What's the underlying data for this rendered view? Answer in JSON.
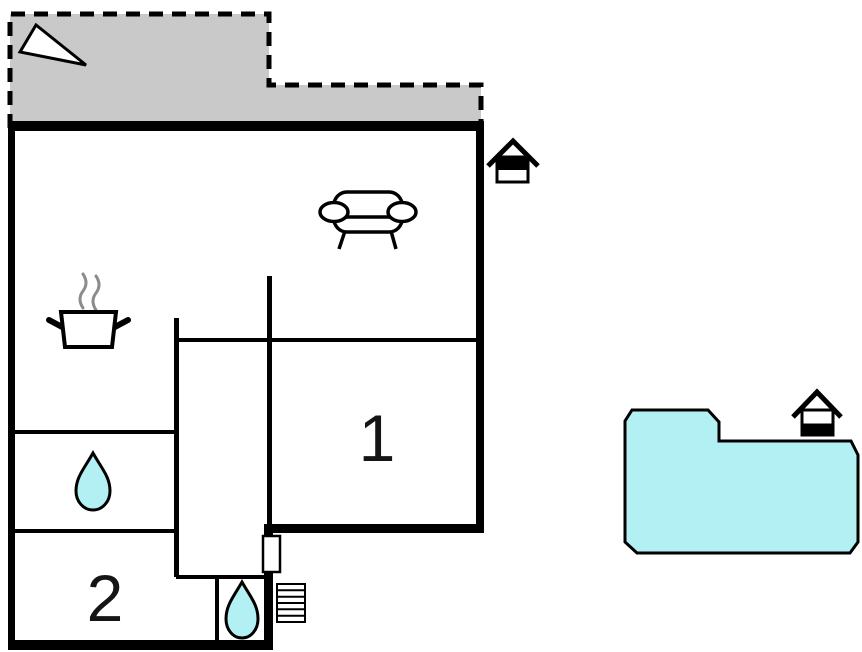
{
  "floorplan": {
    "rooms": [
      {
        "label": "1"
      },
      {
        "label": "2"
      }
    ],
    "terrace": {
      "fill": "#c9c9c9",
      "outline_style": "dashed"
    },
    "pool": {
      "fill": "#b2f0f4"
    },
    "water_drop_fill": "#b2f0f4",
    "wall_color": "#000000",
    "steam_color": "#8c8c8c",
    "icons": [
      "north-arrow-icon",
      "sofa-icon",
      "cooking-pot-icon",
      "water-drop-icon",
      "entrance-door",
      "entrance-steps-icon",
      "house-entrance-icon",
      "swimming-pool"
    ]
  }
}
